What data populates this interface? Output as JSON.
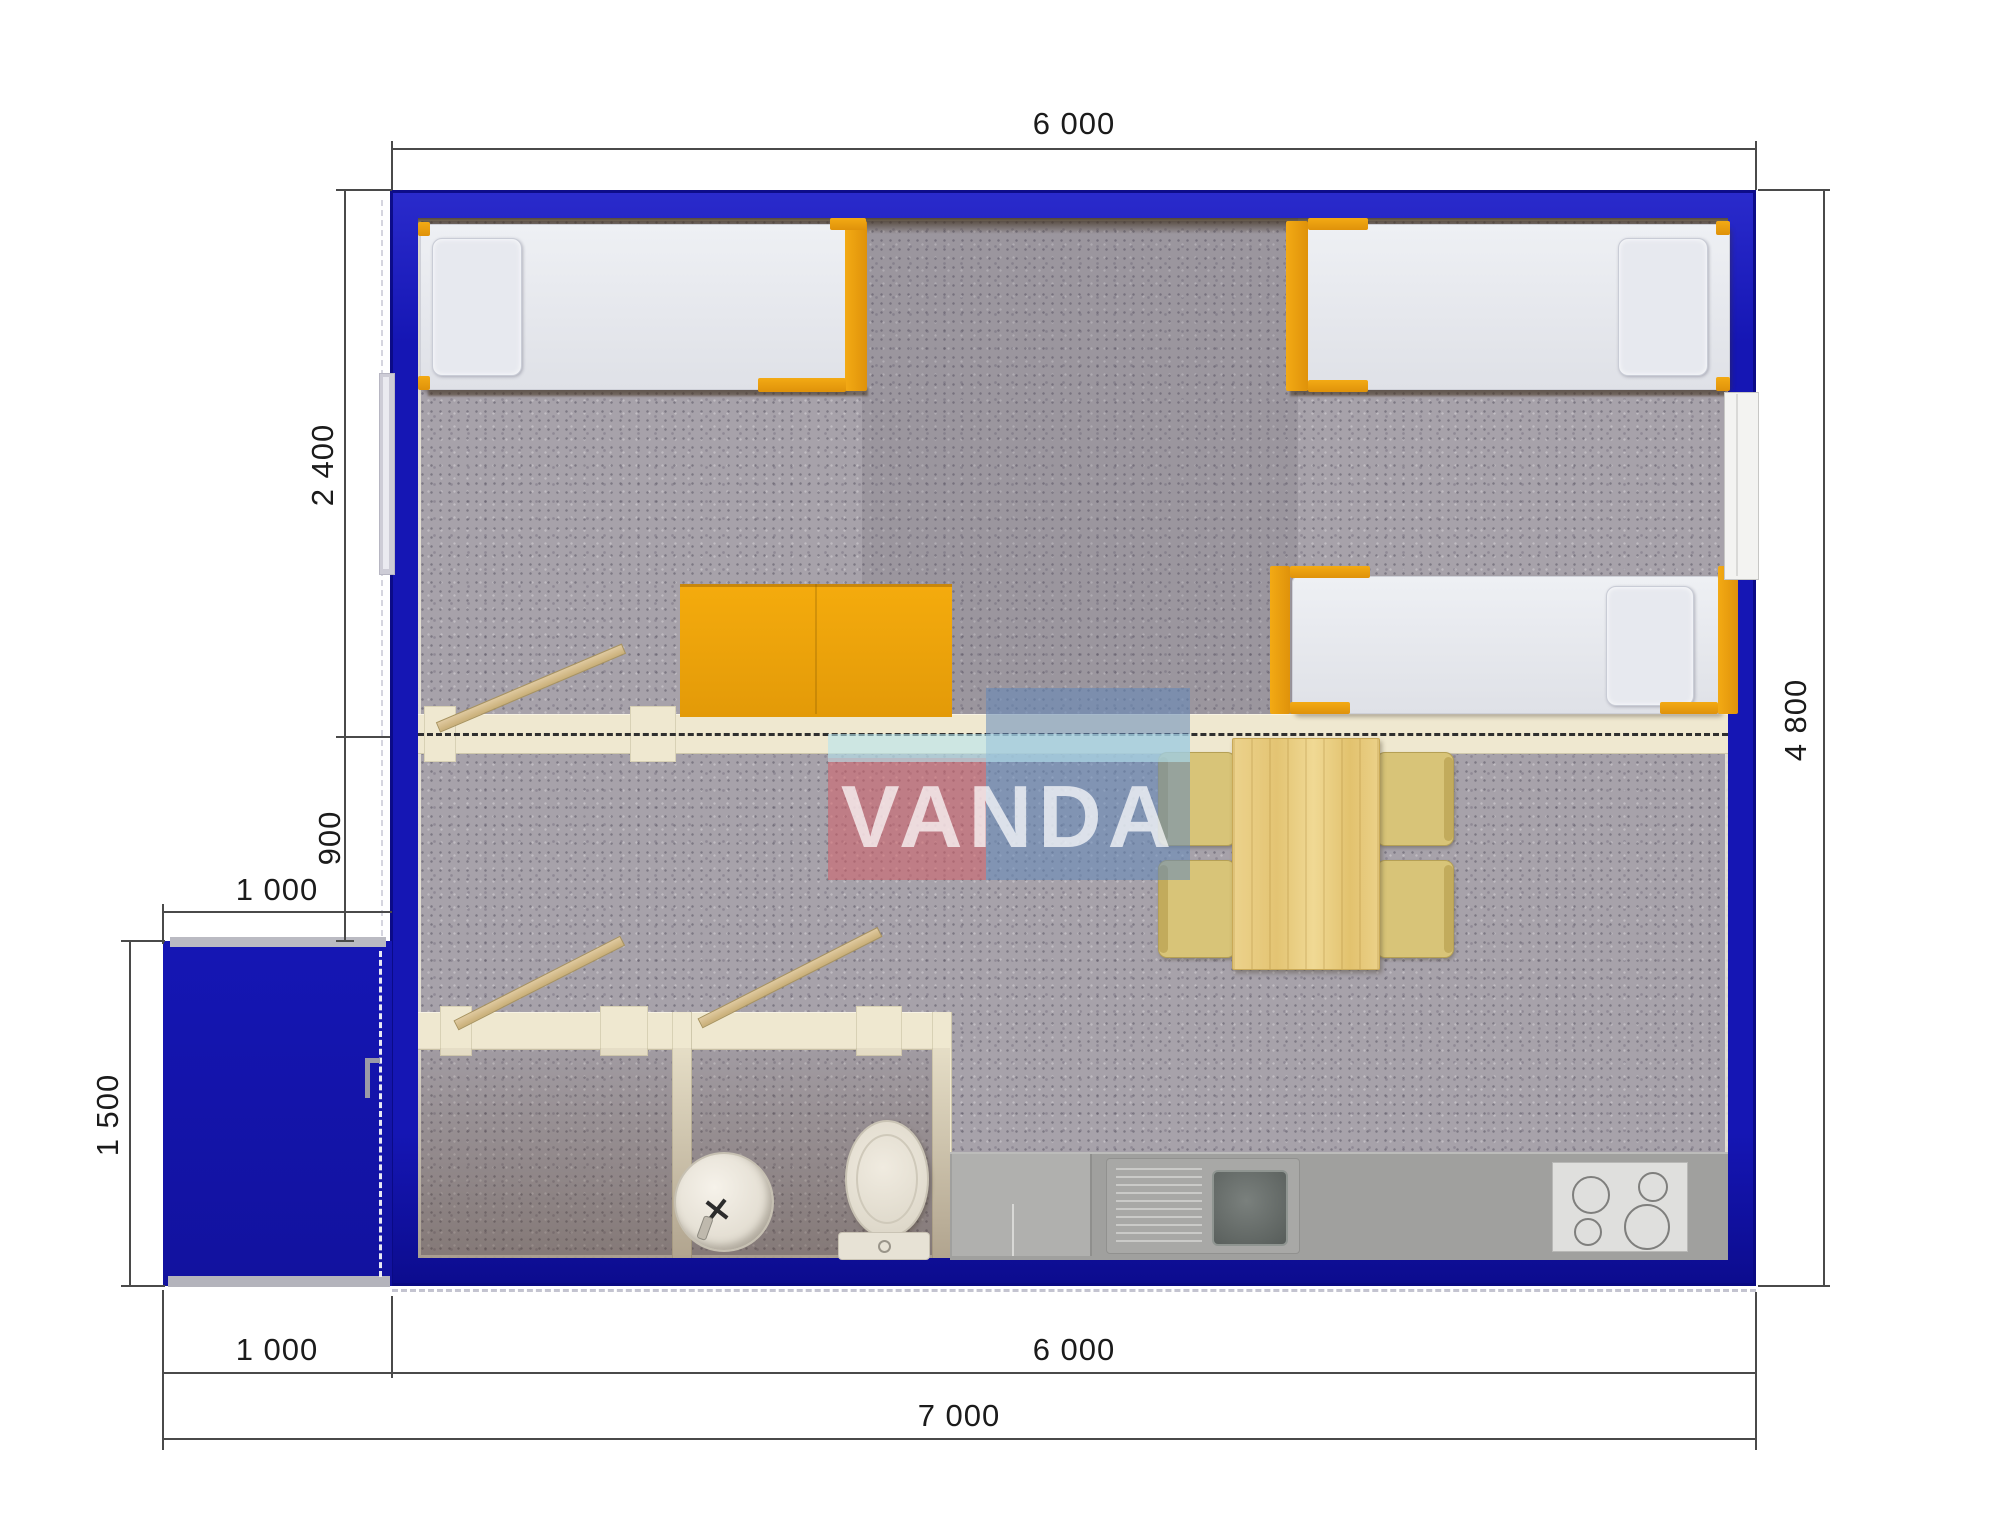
{
  "document": {
    "type": "architectural floor plan render",
    "brand_watermark": "VANDA"
  },
  "watermark": {
    "text": "VANDA"
  },
  "dimensions": {
    "top_width": "6 000",
    "right_total_depth": "4 800",
    "left_bedroom_depth": "2 400",
    "left_partition_offset": "900",
    "porch_width_top": "1 000",
    "porch_depth": "1 500",
    "bottom_porch_width": "1 000",
    "bottom_main_width": "6 000",
    "bottom_total_width": "7 000"
  },
  "colors": {
    "wall_blue": "#1516b4",
    "wall_blue_light": "#2a2bcc",
    "wall_blue_dark": "#0c0c8e",
    "carpet": "#a7a2aa",
    "cream": "#efe8d0",
    "orange": "#efa011",
    "counter": "#a0a09e",
    "dim_line": "#4a4a4a",
    "dim_text": "#1b1b1b",
    "watermark_pink": "rgba(212,94,104,0.55)",
    "watermark_blue": "rgba(98,136,186,0.55)",
    "watermark_cyan": "rgba(182,228,238,0.6)"
  }
}
